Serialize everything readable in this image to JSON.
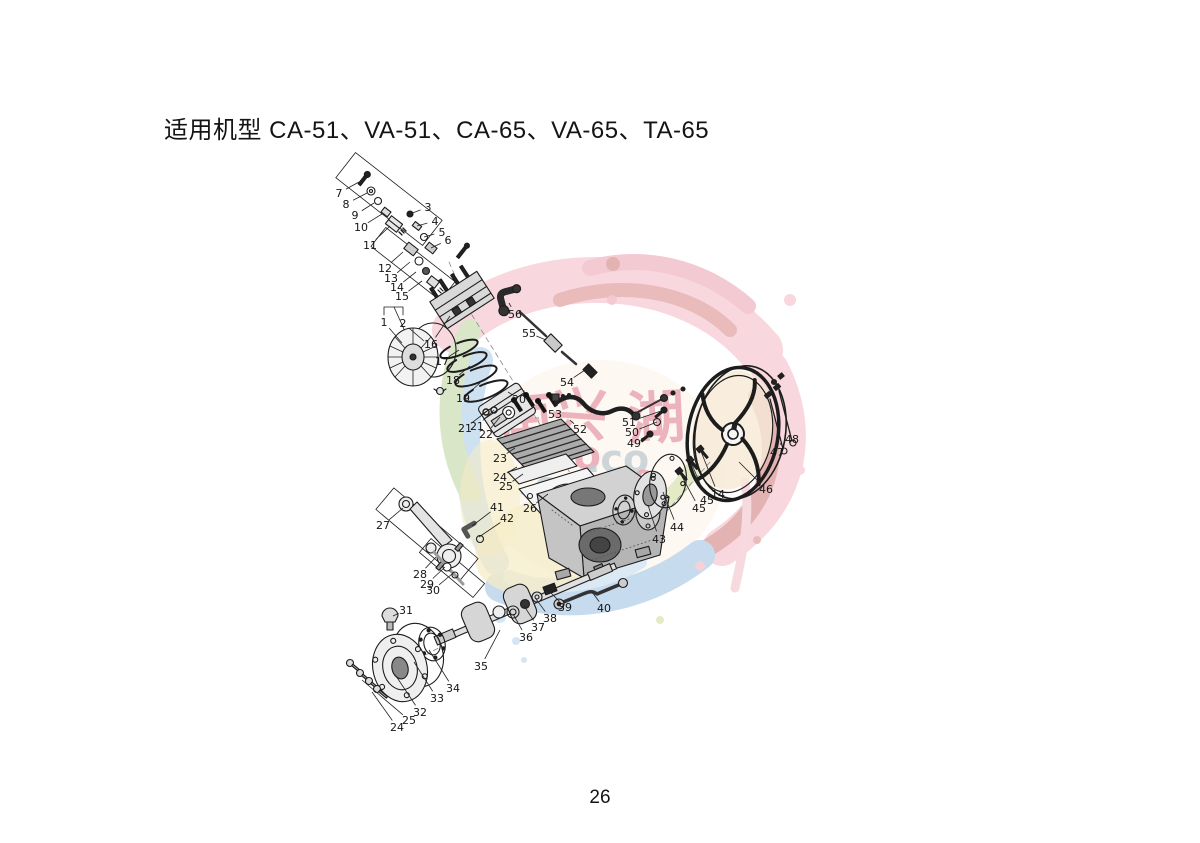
{
  "page": {
    "title": "适用机型 CA-51、VA-51、CA-65、VA-65、TA-65",
    "page_number": "26"
  },
  "watermark": {
    "palette": {
      "pink": "#f2b0bf",
      "rose": "#e995a6",
      "red": "#d47a7a",
      "darkred": "#c96a6a",
      "blue": "#8fb8dc",
      "lightblue": "#b7d4ea",
      "green": "#b6cf92",
      "yellowgreen": "#ccd68f",
      "yellow": "#ecd98f",
      "tan": "#f0d6ae",
      "textpink": "#e9a3b0",
      "textgray": "#c2cdd4"
    },
    "texts": [
      {
        "text": "南",
        "x": 497,
        "y": 392,
        "size": 56,
        "color": "#e9a3b0",
        "rot": -6
      },
      {
        "text": "兴",
        "x": 551,
        "y": 388,
        "size": 56,
        "color": "#e9a3b0",
        "rot": 4
      },
      {
        "text": "湖",
        "x": 627,
        "y": 389,
        "size": 58,
        "color": "#e9a3b0",
        "rot": -3
      },
      {
        "text": "hao",
        "x": 518,
        "y": 436,
        "size": 40,
        "color": "#e9a3b0",
        "rot": 0
      },
      {
        "text": ".co",
        "x": 586,
        "y": 440,
        "size": 38,
        "color": "#c2cdd4",
        "rot": 0
      },
      {
        "text": "-600-7",
        "x": 519,
        "y": 474,
        "size": 34,
        "color": "#c2cdd4",
        "rot": 0
      },
      {
        "text": "49",
        "x": 613,
        "y": 468,
        "size": 30,
        "color": "#e9a3b0",
        "rot": 0
      }
    ]
  },
  "diagram": {
    "type": "exploded-parts-diagram",
    "labels": [
      {
        "n": "1",
        "lx": 384,
        "ly": 322,
        "tx": 402,
        "ty": 343
      },
      {
        "n": "2",
        "lx": 403,
        "ly": 323,
        "tx": 424,
        "ty": 341
      },
      {
        "n": "3",
        "lx": 428,
        "ly": 207,
        "tx": 410,
        "ty": 214
      },
      {
        "n": "4",
        "lx": 435,
        "ly": 221,
        "tx": 417,
        "ty": 226
      },
      {
        "n": "5",
        "lx": 442,
        "ly": 232,
        "tx": 424,
        "ty": 237
      },
      {
        "n": "6",
        "lx": 448,
        "ly": 240,
        "tx": 431,
        "ty": 248
      },
      {
        "n": "7",
        "lx": 339,
        "ly": 193,
        "tx": 359,
        "ty": 182
      },
      {
        "n": "8",
        "lx": 346,
        "ly": 204,
        "tx": 367,
        "ty": 193
      },
      {
        "n": "9",
        "lx": 355,
        "ly": 215,
        "tx": 374,
        "ty": 203
      },
      {
        "n": "10",
        "lx": 361,
        "ly": 227,
        "tx": 382,
        "ty": 214
      },
      {
        "n": "11",
        "lx": 370,
        "ly": 245,
        "tx": 390,
        "ty": 226
      },
      {
        "n": "12",
        "lx": 385,
        "ly": 268,
        "tx": 403,
        "ty": 252
      },
      {
        "n": "13",
        "lx": 391,
        "ly": 278,
        "tx": 410,
        "ty": 262
      },
      {
        "n": "14",
        "lx": 397,
        "ly": 287,
        "tx": 416,
        "ty": 272
      },
      {
        "n": "15",
        "lx": 402,
        "ly": 296,
        "tx": 422,
        "ty": 281
      },
      {
        "n": "16",
        "lx": 431,
        "ly": 344,
        "tx": 450,
        "ty": 316
      },
      {
        "n": "17",
        "lx": 442,
        "ly": 361,
        "tx": 459,
        "ty": 350
      },
      {
        "n": "18",
        "lx": 453,
        "ly": 380,
        "tx": 470,
        "ty": 366
      },
      {
        "n": "19",
        "lx": 463,
        "ly": 398,
        "tx": 480,
        "ty": 383
      },
      {
        "n": "20",
        "lx": 519,
        "ly": 399,
        "tx": 508,
        "ty": 392
      },
      {
        "n": "21",
        "lx": 465,
        "ly": 428,
        "tx": 486,
        "ty": 412
      },
      {
        "n": "21",
        "lx": 477,
        "ly": 426,
        "tx": 494,
        "ty": 410
      },
      {
        "n": "22",
        "lx": 486,
        "ly": 434,
        "tx": 500,
        "ty": 417
      },
      {
        "n": "23",
        "lx": 500,
        "ly": 458,
        "tx": 515,
        "ty": 448
      },
      {
        "n": "24",
        "lx": 500,
        "ly": 477,
        "tx": 517,
        "ty": 467
      },
      {
        "n": "25",
        "lx": 506,
        "ly": 486,
        "tx": 523,
        "ty": 474
      },
      {
        "n": "26",
        "lx": 530,
        "ly": 508,
        "tx": 548,
        "ty": 494
      },
      {
        "n": "27",
        "lx": 383,
        "ly": 525,
        "tx": 403,
        "ty": 508
      },
      {
        "n": "28",
        "lx": 420,
        "ly": 574,
        "tx": 436,
        "ty": 557
      },
      {
        "n": "29",
        "lx": 427,
        "ly": 584,
        "tx": 445,
        "ty": 567
      },
      {
        "n": "30",
        "lx": 433,
        "ly": 590,
        "tx": 452,
        "ty": 574
      },
      {
        "n": "31",
        "lx": 406,
        "ly": 610,
        "tx": 393,
        "ty": 616
      },
      {
        "n": "24",
        "lx": 397,
        "ly": 727,
        "tx": 372,
        "ty": 692
      },
      {
        "n": "25",
        "lx": 409,
        "ly": 720,
        "tx": 362,
        "ty": 680
      },
      {
        "n": "32",
        "lx": 420,
        "ly": 712,
        "tx": 396,
        "ty": 676
      },
      {
        "n": "33",
        "lx": 437,
        "ly": 698,
        "tx": 414,
        "ty": 662
      },
      {
        "n": "34",
        "lx": 453,
        "ly": 688,
        "tx": 429,
        "ty": 650
      },
      {
        "n": "35",
        "lx": 481,
        "ly": 666,
        "tx": 500,
        "ty": 630
      },
      {
        "n": "36",
        "lx": 526,
        "ly": 637,
        "tx": 513,
        "ty": 614
      },
      {
        "n": "37",
        "lx": 538,
        "ly": 627,
        "tx": 524,
        "ty": 606
      },
      {
        "n": "38",
        "lx": 550,
        "ly": 618,
        "tx": 536,
        "ty": 599
      },
      {
        "n": "39",
        "lx": 565,
        "ly": 607,
        "tx": 549,
        "ty": 591
      },
      {
        "n": "40",
        "lx": 604,
        "ly": 608,
        "tx": 592,
        "ty": 592
      },
      {
        "n": "41",
        "lx": 497,
        "ly": 507,
        "tx": 472,
        "ty": 526
      },
      {
        "n": "42",
        "lx": 507,
        "ly": 518,
        "tx": 479,
        "ty": 537
      },
      {
        "n": "43",
        "lx": 659,
        "ly": 539,
        "tx": 648,
        "ty": 505
      },
      {
        "n": "44",
        "lx": 677,
        "ly": 527,
        "tx": 663,
        "ty": 492
      },
      {
        "n": "45",
        "lx": 699,
        "ly": 508,
        "tx": 679,
        "ty": 471
      },
      {
        "n": "45",
        "lx": 707,
        "ly": 500,
        "tx": 690,
        "ty": 460
      },
      {
        "n": "14",
        "lx": 718,
        "ly": 494,
        "tx": 700,
        "ty": 449
      },
      {
        "n": "46",
        "lx": 766,
        "ly": 489,
        "tx": 739,
        "ty": 462
      },
      {
        "n": "47",
        "lx": 777,
        "ly": 452,
        "tx": 781,
        "ty": 443
      },
      {
        "n": "48",
        "lx": 792,
        "ly": 439,
        "tx": 790,
        "ty": 432
      },
      {
        "n": "49",
        "lx": 634,
        "ly": 443,
        "tx": 650,
        "ty": 434
      },
      {
        "n": "50",
        "lx": 632,
        "ly": 432,
        "tx": 657,
        "ty": 422
      },
      {
        "n": "51",
        "lx": 629,
        "ly": 422,
        "tx": 664,
        "ty": 410
      },
      {
        "n": "52",
        "lx": 580,
        "ly": 429,
        "tx": 570,
        "ty": 420
      },
      {
        "n": "53",
        "lx": 555,
        "ly": 414,
        "tx": 556,
        "ty": 401
      },
      {
        "n": "54",
        "lx": 567,
        "ly": 382,
        "tx": 585,
        "ty": 370
      },
      {
        "n": "55",
        "lx": 529,
        "ly": 333,
        "tx": 546,
        "ty": 340
      },
      {
        "n": "56",
        "lx": 515,
        "ly": 314,
        "tx": 509,
        "ty": 303
      }
    ]
  }
}
